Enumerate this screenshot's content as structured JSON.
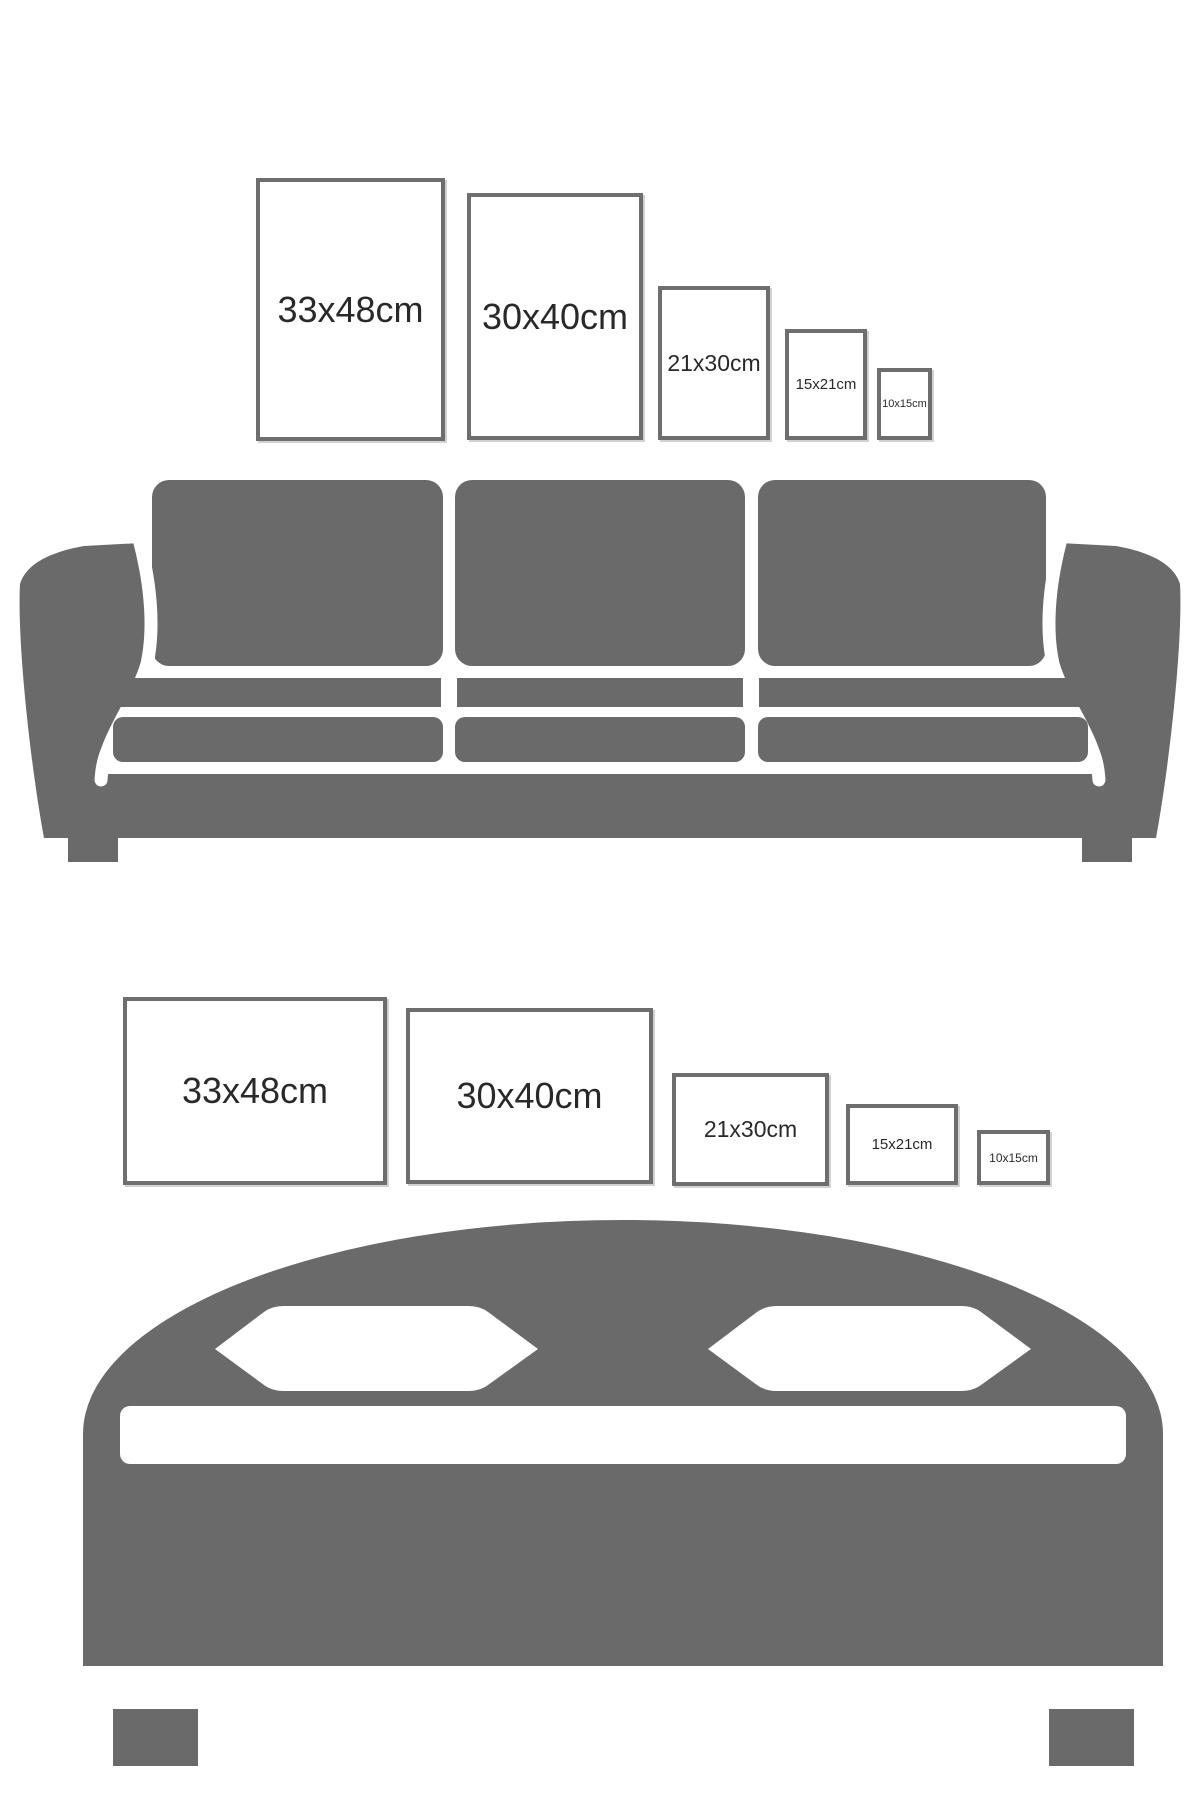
{
  "page": {
    "description": "Poster size comparison guide showing five frame sizes above a sofa (portrait orientation) and above a bed (landscape orientation)",
    "background_color": "#ffffff"
  },
  "colors": {
    "furniture_gray": "#6a6a6a",
    "frame_border_gray": "#6e6e6e",
    "frame_shadow": "#d2d2d2",
    "label_text": "#2b2829",
    "frame_fill": "#ffffff"
  },
  "sofa_wall": {
    "orientation": "portrait",
    "frames": [
      {
        "label": "33x48cm"
      },
      {
        "label": "30x40cm"
      },
      {
        "label": "21x30cm"
      },
      {
        "label": "15x21cm"
      },
      {
        "label": "10x15cm"
      }
    ]
  },
  "bed_wall": {
    "orientation": "landscape",
    "frames": [
      {
        "label": "33x48cm"
      },
      {
        "label": "30x40cm"
      },
      {
        "label": "21x30cm"
      },
      {
        "label": "15x21cm"
      },
      {
        "label": "10x15cm"
      }
    ]
  },
  "illustrations": {
    "sofa": "three-seat sofa silhouette",
    "bed": "double bed with two pillows silhouette"
  }
}
